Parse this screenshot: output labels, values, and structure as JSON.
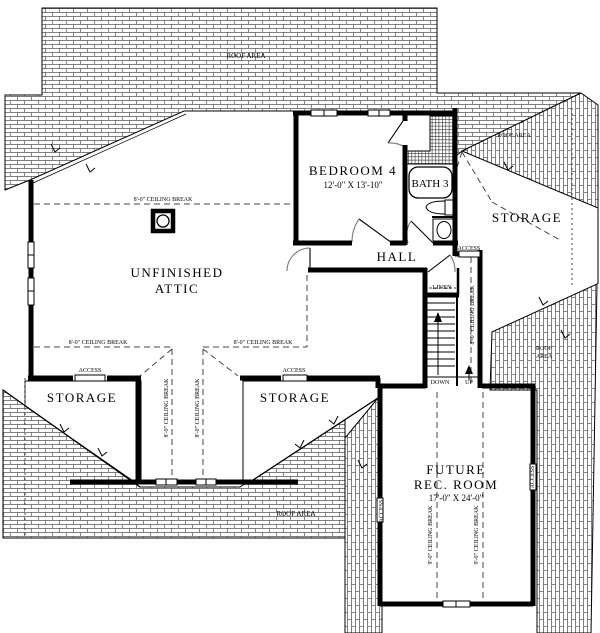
{
  "plan": {
    "type": "second-floor-plan",
    "colors": {
      "line": "#000000",
      "background": "#ffffff",
      "shingle_line": "#555555"
    },
    "rooms": [
      {
        "name": "unfinished-attic",
        "label": "UNFINISHED ATTIC"
      },
      {
        "name": "bedroom-4",
        "label": "BEDROOM 4",
        "dims": "12'-0\" X 13'-10\""
      },
      {
        "name": "bath-3",
        "label": "BATH 3"
      },
      {
        "name": "storage-right",
        "label": "STORAGE"
      },
      {
        "name": "hall",
        "label": "HALL"
      },
      {
        "name": "linen",
        "label": "LINEN"
      },
      {
        "name": "storage-left",
        "label": "STORAGE"
      },
      {
        "name": "storage-middle",
        "label": "STORAGE"
      },
      {
        "name": "future-rec-room",
        "label": "FUTURE REC. ROOM",
        "dims": "17'-0\" X 24'-0\""
      }
    ],
    "stairs": {
      "down_label": "DOWN",
      "up_label": "UP"
    },
    "labels": [
      {
        "id": "roof-area-top",
        "text": "ROOF AREA",
        "x": 246,
        "y": 58,
        "size": 7
      },
      {
        "id": "roof-area-topright",
        "text": "ROOF AREA",
        "x": 514,
        "y": 137,
        "size": 6
      },
      {
        "id": "roof-area-right-1",
        "text": "ROOF",
        "x": 544,
        "y": 350,
        "size": 6
      },
      {
        "id": "roof-area-right-2",
        "text": "AREA",
        "x": 544,
        "y": 358,
        "size": 6
      },
      {
        "id": "roof-area-bottom",
        "text": "ROOF AREA",
        "x": 296,
        "y": 516,
        "size": 7
      },
      {
        "id": "cb-attic",
        "text": "8'-0\" CEILING BREAK",
        "x": 163,
        "y": 201,
        "size": 6
      },
      {
        "id": "cb-mid-left",
        "text": "8'-0\" CEILING BREAK",
        "x": 98,
        "y": 344,
        "size": 6
      },
      {
        "id": "cb-mid-right",
        "text": "8'-0\" CEILING BREAK",
        "x": 263,
        "y": 344,
        "size": 6
      },
      {
        "id": "cb-v1",
        "text": "8'-0\" CEILING BREAK",
        "x": 168,
        "y": 408,
        "size": 6,
        "rotate": -90
      },
      {
        "id": "cb-v2",
        "text": "8'-0\" CEILING BREAK",
        "x": 199,
        "y": 408,
        "size": 6,
        "rotate": -90
      },
      {
        "id": "cb-stairs",
        "text": "8'-0\" CEILING BREAK",
        "x": 474,
        "y": 315,
        "size": 6,
        "rotate": -90
      },
      {
        "id": "cb-rec1",
        "text": "9'-0\" CEILING BREAK",
        "x": 432,
        "y": 535,
        "size": 6,
        "rotate": -90
      },
      {
        "id": "cb-rec2",
        "text": "9'-0\" CEILING BREAK",
        "x": 478,
        "y": 535,
        "size": 6,
        "rotate": -90
      },
      {
        "id": "attic-line1",
        "text": "UNFINISHED",
        "x": 177,
        "y": 277,
        "size": 13,
        "room": true
      },
      {
        "id": "attic-line2",
        "text": "ATTIC",
        "x": 177,
        "y": 293,
        "size": 13,
        "room": true
      },
      {
        "id": "bedroom",
        "text": "BEDROOM 4",
        "x": 353,
        "y": 175,
        "size": 13,
        "room": true
      },
      {
        "id": "bedroom-dims",
        "text": "12'-0\" X 13'-10\"",
        "x": 353,
        "y": 188,
        "size": 9
      },
      {
        "id": "bath",
        "text": "BATH 3",
        "x": 430,
        "y": 187,
        "size": 11
      },
      {
        "id": "storage-r",
        "text": "STORAGE",
        "x": 527,
        "y": 222,
        "size": 13,
        "room": true
      },
      {
        "id": "hall",
        "text": "HALL",
        "x": 397,
        "y": 261,
        "size": 13,
        "room": true
      },
      {
        "id": "linen",
        "text": "LINEN",
        "x": 442,
        "y": 289,
        "size": 6.5
      },
      {
        "id": "storage-l",
        "text": "STORAGE",
        "x": 82,
        "y": 402,
        "size": 13,
        "room": true
      },
      {
        "id": "storage-m",
        "text": "STORAGE",
        "x": 295,
        "y": 402,
        "size": 13,
        "room": true
      },
      {
        "id": "rec-line1",
        "text": "FUTURE",
        "x": 456,
        "y": 474,
        "size": 13,
        "room": true
      },
      {
        "id": "rec-line2",
        "text": "REC. ROOM",
        "x": 456,
        "y": 489,
        "size": 13,
        "room": true
      },
      {
        "id": "rec-dims",
        "text": "17'-0\" X 24'-0\"",
        "x": 456,
        "y": 501,
        "size": 9
      },
      {
        "id": "down",
        "text": "DOWN",
        "x": 440,
        "y": 384,
        "size": 6
      },
      {
        "id": "up",
        "text": "UP",
        "x": 469,
        "y": 384,
        "size": 6
      },
      {
        "id": "access-storage-l",
        "text": "ACCESS",
        "x": 90,
        "y": 372,
        "size": 6
      },
      {
        "id": "access-storage-m",
        "text": "ACCESS",
        "x": 294,
        "y": 372,
        "size": 6
      },
      {
        "id": "access-stairs",
        "text": "ACCESS",
        "x": 469,
        "y": 250,
        "size": 6
      },
      {
        "id": "access-rec-l",
        "text": "ACCESS",
        "x": 383,
        "y": 511,
        "size": 6,
        "rotate": -90
      },
      {
        "id": "access-rec-r",
        "text": "ACCESS",
        "x": 534,
        "y": 477,
        "size": 6,
        "rotate": -90
      }
    ]
  }
}
